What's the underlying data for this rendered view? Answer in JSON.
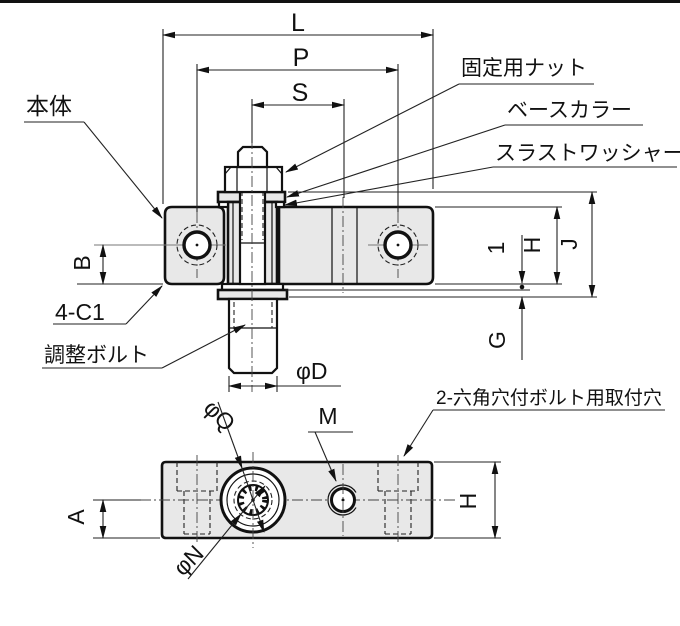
{
  "drawing": {
    "type": "technical-drawing",
    "colors": {
      "part_fill": "#e8e8e8",
      "line": "#111111",
      "background": "#ffffff"
    },
    "main_view": {
      "dim_l": "L",
      "dim_p": "P",
      "dim_s": "S",
      "dim_b": "B",
      "dim_one": "1",
      "dim_h": "H",
      "dim_j": "J",
      "dim_g": "G",
      "dim_phi_d": "φD",
      "label_body": "本体",
      "label_lock_nut": "固定用ナット",
      "label_base_collar": "ベースカラー",
      "label_thrust_washer": "スラストワッシャー",
      "label_chamfer": "4-C1",
      "label_adjust_bolt": "調整ボルト"
    },
    "top_view": {
      "dim_phi_q": "φQ",
      "dim_m": "M",
      "dim_phi_n": "φN",
      "dim_a": "A",
      "dim_h": "H",
      "label_mounting_holes": "2-六角穴付ボルト用取付穴"
    }
  }
}
